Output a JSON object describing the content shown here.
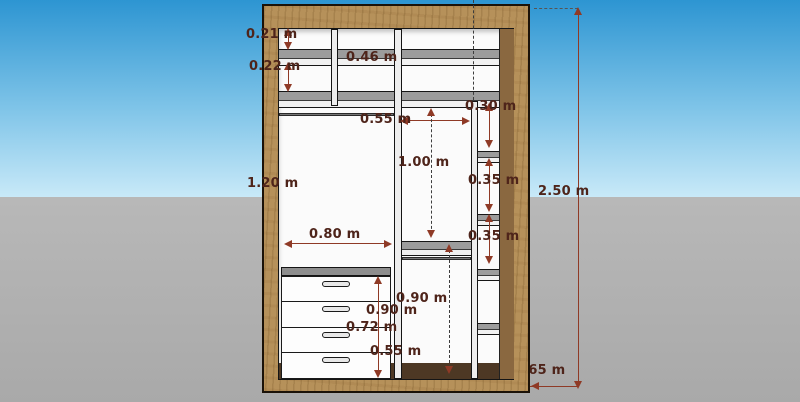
{
  "scene": {
    "type": "wardrobe-dimension-diagram",
    "colors": {
      "sky_top": "#2d95d2",
      "sky_bottom": "#c8e9f8",
      "ground": "#aeaeae",
      "wood_frame": "#b6915a",
      "wood_inner": "#8a6840",
      "shelf_gray": "#9c9c9c",
      "dimension_color": "#8f3a26",
      "dimension_text": "#4e241a"
    }
  },
  "labels": {
    "dim_0_21": "0.21 m",
    "dim_0_22": "0.22 m",
    "dim_0_46": "0.46 m",
    "dim_0_30": "0.30 m",
    "dim_0_55_top": "0.55 m",
    "dim_1_00": "1.00 m",
    "dim_1_20": "1.20 m",
    "dim_0_35_a": "0.35 m",
    "dim_0_35_b": "0.35 m",
    "dim_0_80": "0.80 m",
    "dim_0_90_mid": "0.90 m",
    "dim_0_90_drawers": "0.90 m",
    "dim_0_72": "0.72 m",
    "dim_0_55_bottom": "0.55 m",
    "dim_2_50": "2.50 m",
    "dim_0_65": "0.65 m"
  }
}
